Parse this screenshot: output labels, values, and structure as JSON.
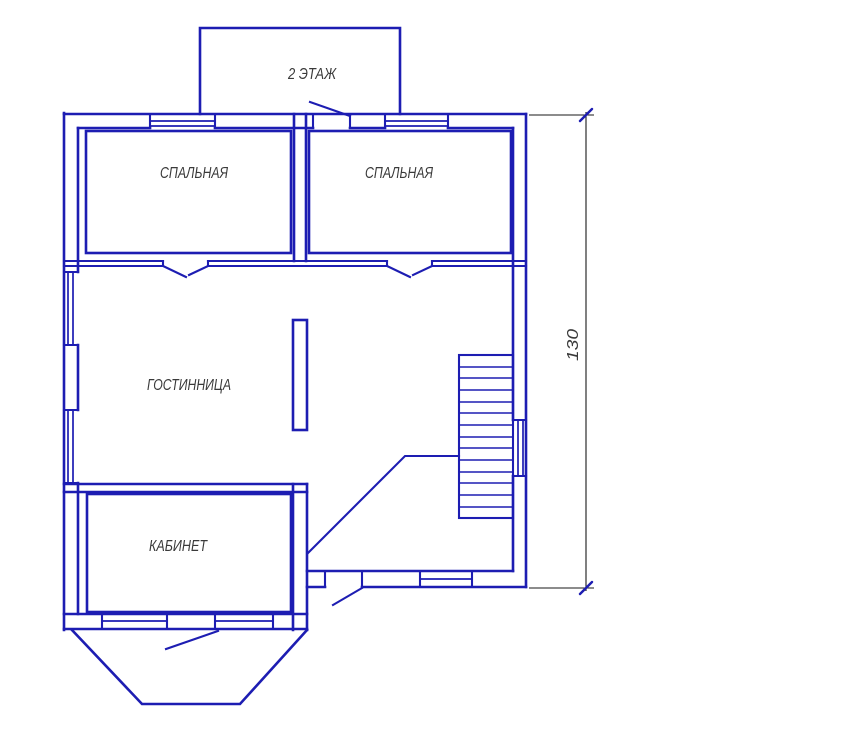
{
  "drawing": {
    "floor_label": "2 ЭТАЖ",
    "room_labels": {
      "bedroom_left": "СПАЛЬНАЯ",
      "bedroom_right": "СПАЛЬНАЯ",
      "living_room": "ГОСТИННИЦА",
      "office": "КАБИНЕТ"
    },
    "dimension": {
      "value": "130"
    },
    "colors": {
      "wall": "#1d1db2",
      "dimension_line": "#1a1a1a",
      "text": "#3a3a3a",
      "background": "#ffffff"
    }
  }
}
